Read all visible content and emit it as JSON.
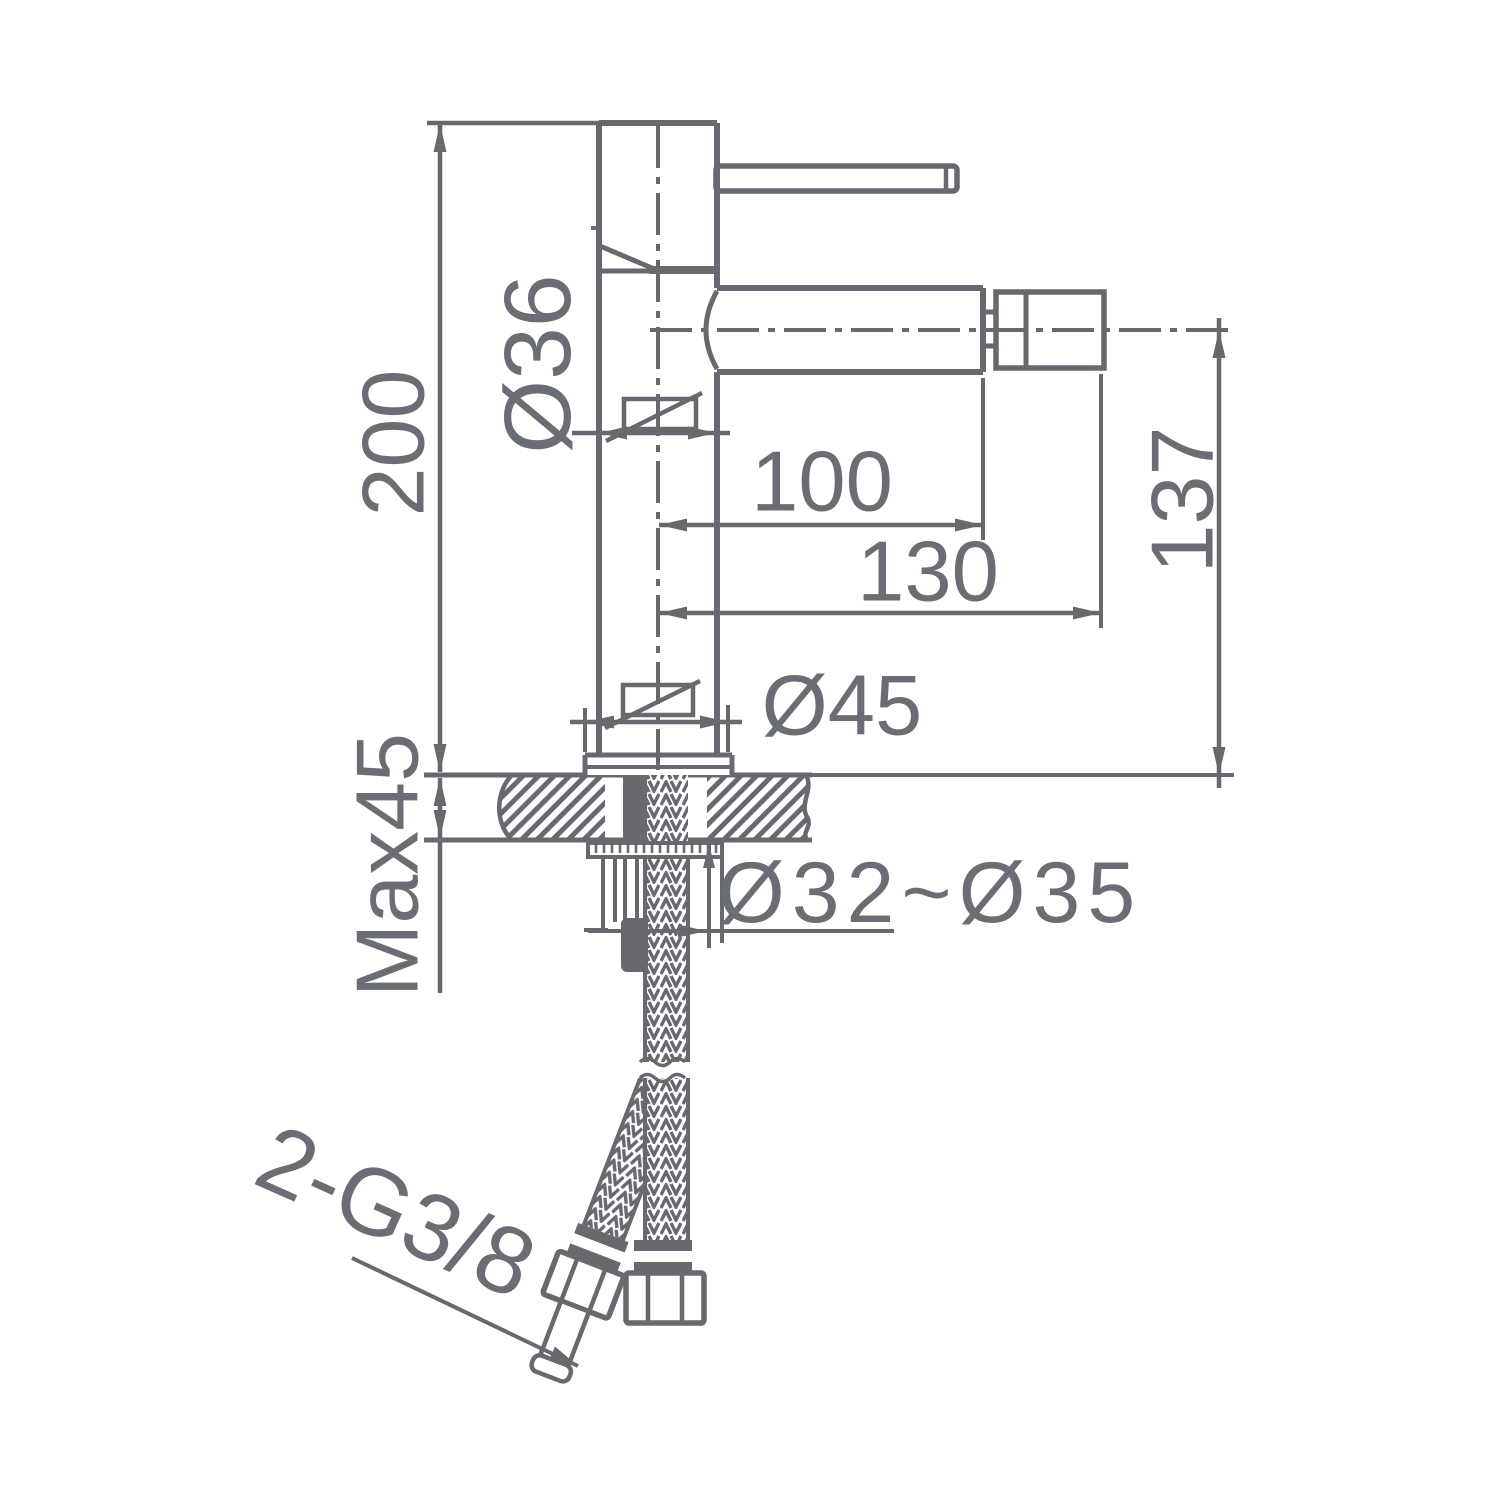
{
  "diagram": {
    "type": "technical-drawing",
    "subject": "single-lever basin/bidet mixer tap, side elevation with installation dimensions",
    "units": "mm",
    "colors": {
      "line": "#67696f",
      "text": "#6a6d73",
      "background": "#ffffff"
    },
    "labels": {
      "overall_height": "200",
      "body_diameter": "Ø36",
      "spout_reach": "100",
      "overall_reach": "130",
      "spout_height": "137",
      "base_diameter": "Ø45",
      "max_deck_thickness": "Max45",
      "mounting_hole_diameter": "Ø32~Ø35",
      "supply_hose_thread": "2-G3/8"
    }
  }
}
